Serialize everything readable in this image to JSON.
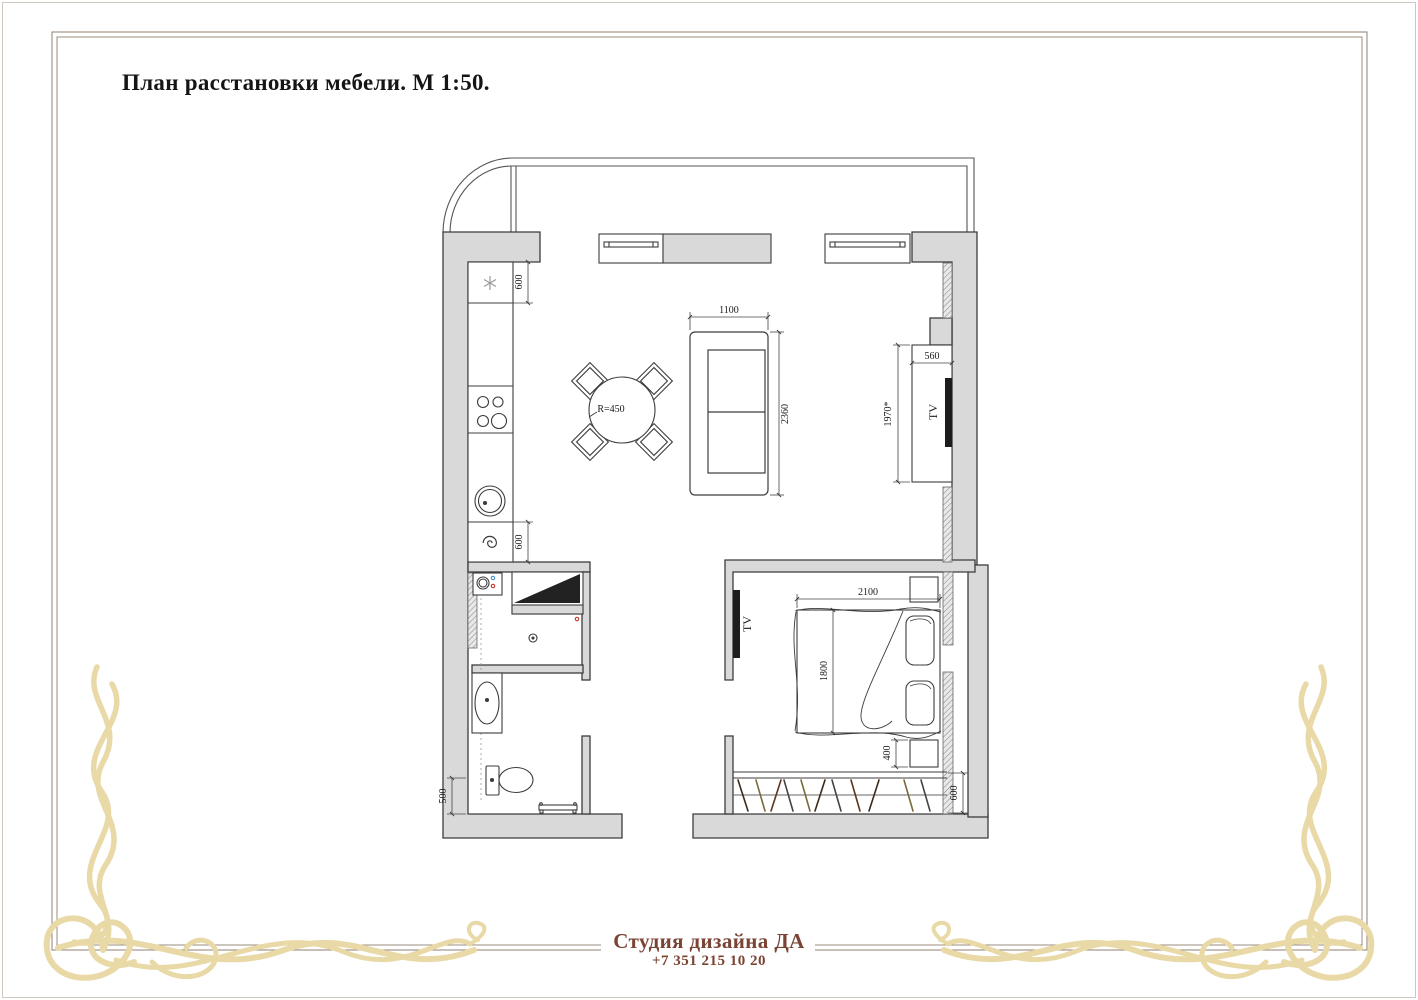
{
  "page": {
    "title": "План расстановки мебели. М 1:50.",
    "footer": {
      "studio": "Студия дизайна ДА",
      "phone": "+7 351 215 10 20"
    },
    "colors": {
      "wall_fill": "#d9d9d9",
      "plan_line": "#3c3c3c",
      "frame_line": "#9b8c7e",
      "ornament_gold": "#e8d9a6",
      "footer_text": "#7a4434",
      "tv_black": "#1c1c1c",
      "dot_red": "#c0392b",
      "dot_blue": "#4a90c4"
    }
  },
  "plan": {
    "labels": {
      "kitchen_fridge_depth": "600",
      "kitchen_counter_depth": "600",
      "table_radius": "R=450",
      "sofa_width": "1100",
      "sofa_length": "2360",
      "tv_unit_depth": "560",
      "tv_unit_length": "1970*",
      "tv_living": "TV",
      "tv_bedroom": "TV",
      "bed_width": "2100",
      "bed_length": "1800",
      "nightstand_depth": "400",
      "wardrobe_depth": "600",
      "wc_clearance": "500"
    }
  }
}
